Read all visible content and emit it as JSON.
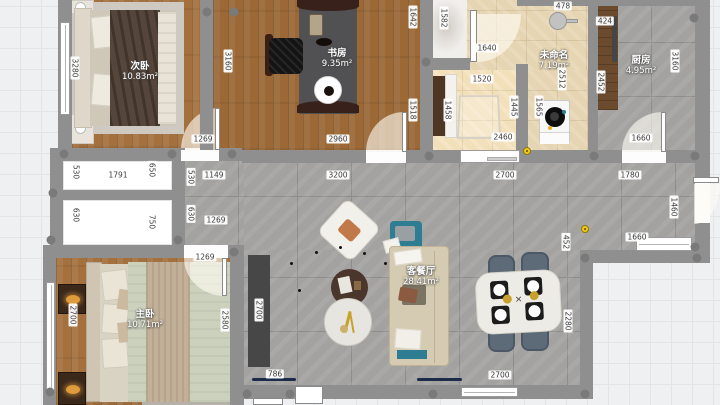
{
  "rooms": [
    {
      "name": "次卧",
      "area": "10.83m²"
    },
    {
      "name": "书房",
      "area": "9.35m²"
    },
    {
      "name": "未命名",
      "area": "7.19m²"
    },
    {
      "name": "厨房",
      "area": "4.95m²"
    },
    {
      "name": "主卧",
      "area": "10.71m²"
    },
    {
      "name": "客餐厅",
      "area": "28.41m²"
    }
  ],
  "dimension_labels": [
    {
      "t": "3280",
      "x": 75,
      "y": 68,
      "v": 1
    },
    {
      "t": "3160",
      "x": 228,
      "y": 61,
      "v": 1
    },
    {
      "t": "1269",
      "x": 203,
      "y": 139
    },
    {
      "t": "2960",
      "x": 338,
      "y": 139
    },
    {
      "t": "1642",
      "x": 413,
      "y": 17,
      "v": 1
    },
    {
      "t": "1518",
      "x": 413,
      "y": 110,
      "v": 1
    },
    {
      "t": "1582",
      "x": 444,
      "y": 18,
      "v": 1
    },
    {
      "t": "1640",
      "x": 487,
      "y": 48
    },
    {
      "t": "478",
      "x": 563,
      "y": 6
    },
    {
      "t": "1520",
      "x": 482,
      "y": 79
    },
    {
      "t": "1458",
      "x": 448,
      "y": 110,
      "v": 1
    },
    {
      "t": "1445",
      "x": 514,
      "y": 107,
      "v": 1
    },
    {
      "t": "1565",
      "x": 539,
      "y": 107,
      "v": 1
    },
    {
      "t": "2512",
      "x": 562,
      "y": 79,
      "v": 1
    },
    {
      "t": "2460",
      "x": 503,
      "y": 137
    },
    {
      "t": "424",
      "x": 605,
      "y": 21
    },
    {
      "t": "2452",
      "x": 601,
      "y": 82,
      "v": 1
    },
    {
      "t": "3160",
      "x": 675,
      "y": 61,
      "v": 1
    },
    {
      "t": "1660",
      "x": 641,
      "y": 138
    },
    {
      "t": "530",
      "x": 76,
      "y": 172,
      "v": 1
    },
    {
      "t": "1791",
      "x": 118,
      "y": 175
    },
    {
      "t": "650",
      "x": 152,
      "y": 170,
      "v": 1
    },
    {
      "t": "530",
      "x": 191,
      "y": 177,
      "v": 1
    },
    {
      "t": "1149",
      "x": 214,
      "y": 175
    },
    {
      "t": "3200",
      "x": 338,
      "y": 175
    },
    {
      "t": "2700",
      "x": 505,
      "y": 175
    },
    {
      "t": "1780",
      "x": 630,
      "y": 175
    },
    {
      "t": "630",
      "x": 76,
      "y": 215,
      "v": 1
    },
    {
      "t": "750",
      "x": 152,
      "y": 222,
      "v": 1
    },
    {
      "t": "630",
      "x": 191,
      "y": 214,
      "v": 1
    },
    {
      "t": "1269",
      "x": 216,
      "y": 220
    },
    {
      "t": "1460",
      "x": 674,
      "y": 207,
      "v": 1
    },
    {
      "t": "1660",
      "x": 637,
      "y": 237
    },
    {
      "t": "452",
      "x": 566,
      "y": 242,
      "v": 1
    },
    {
      "t": "1269",
      "x": 205,
      "y": 257
    },
    {
      "t": "2700",
      "x": 73,
      "y": 315,
      "v": 1
    },
    {
      "t": "2580",
      "x": 225,
      "y": 320,
      "v": 1
    },
    {
      "t": "2700",
      "x": 259,
      "y": 310,
      "v": 1
    },
    {
      "t": "786",
      "x": 275,
      "y": 374
    },
    {
      "t": "2700",
      "x": 500,
      "y": 375
    },
    {
      "t": "2280",
      "x": 568,
      "y": 321,
      "v": 1
    }
  ],
  "wall_dots": [
    [
      207,
      12
    ],
    [
      234,
      12
    ],
    [
      64,
      154
    ],
    [
      172,
      154
    ],
    [
      232,
      154
    ],
    [
      53,
      193
    ],
    [
      51,
      240
    ],
    [
      50,
      392
    ],
    [
      178,
      240
    ],
    [
      234,
      252
    ],
    [
      426,
      62
    ],
    [
      429,
      156
    ],
    [
      594,
      156
    ],
    [
      695,
      156
    ],
    [
      695,
      247
    ],
    [
      585,
      258
    ],
    [
      697,
      258
    ],
    [
      585,
      394
    ],
    [
      433,
      394
    ],
    [
      290,
      394
    ],
    [
      247,
      394
    ],
    [
      694,
      18
    ]
  ],
  "yellow_markers": [
    [
      527,
      151
    ],
    [
      585,
      229
    ]
  ],
  "colors": {
    "wall": "#8f8f8f",
    "wall_dot": "#7a7a7a",
    "outside": "#eff0f1",
    "grid": "#e3e4e6",
    "wood1": "#a4703d",
    "tile": "#a3a2a0",
    "tile_line": "#8e8d8b",
    "beige": "#e6d5b2",
    "beige_line": "#d6c49e",
    "marble": "#f1efec",
    "white_room": "#ffffff",
    "dim_text": "#3c3c3c",
    "teal": "#2e7d92",
    "navy": "#1c2b49",
    "tv_cab": "#474747",
    "chair_gray": "#5d6b79",
    "wood_cab": "#6b4a2e",
    "orange": "#df9b3a",
    "gold": "#c7a12b"
  }
}
